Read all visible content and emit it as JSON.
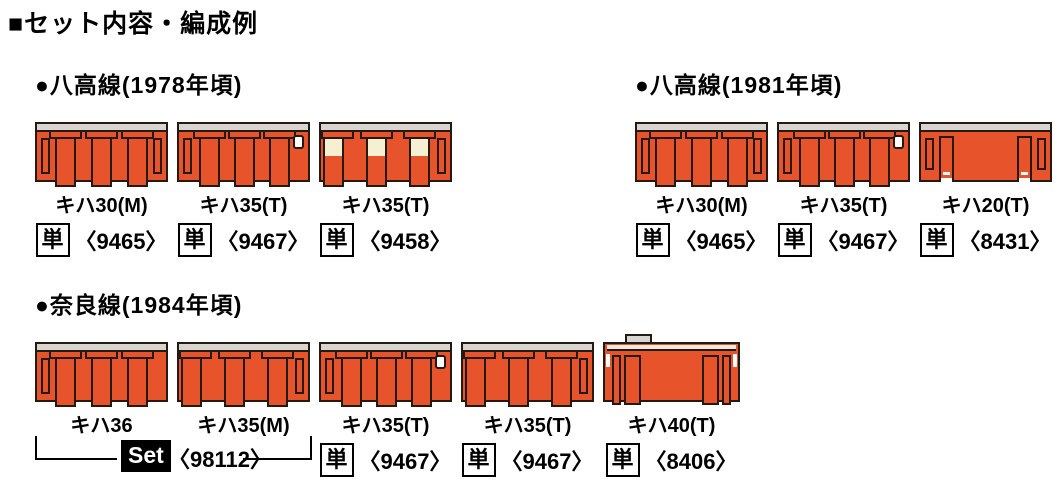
{
  "title": "■セット内容・編成例",
  "colors": {
    "car_orange": "#E7532A",
    "car_cream": "#F6F0D3",
    "roof_gray": "#D8D5D0",
    "outline": "#221A13",
    "set_badge_bg": "#000000",
    "set_badge_text": "#FFFFFF"
  },
  "sections": [
    {
      "heading": "●八高線(1978年頃)",
      "cars": [
        {
          "name": "キハ30(M)",
          "badge": "単",
          "number": "〈9465〉"
        },
        {
          "name": "キハ35(T)",
          "badge": "単",
          "number": "〈9467〉"
        },
        {
          "name": "キハ35(T)",
          "badge": "単",
          "number": "〈9458〉"
        }
      ]
    },
    {
      "heading": "●八高線(1981年頃)",
      "cars": [
        {
          "name": "キハ30(M)",
          "badge": "単",
          "number": "〈9465〉"
        },
        {
          "name": "キハ35(T)",
          "badge": "単",
          "number": "〈9467〉"
        },
        {
          "name": "キハ20(T)",
          "badge": "単",
          "number": "〈8431〉"
        }
      ]
    },
    {
      "heading": "●奈良線(1984年頃)",
      "cars": [
        {
          "name": "キハ36"
        },
        {
          "name": "キハ35(M)"
        },
        {
          "name": "キハ35(T)",
          "badge": "単",
          "number": "〈9467〉"
        },
        {
          "name": "キハ35(T)",
          "badge": "単",
          "number": "〈9467〉"
        },
        {
          "name": "キハ40(T)",
          "badge": "単",
          "number": "〈8406〉"
        }
      ],
      "set_group": {
        "label": "Set",
        "number": "〈98112〉"
      }
    }
  ]
}
